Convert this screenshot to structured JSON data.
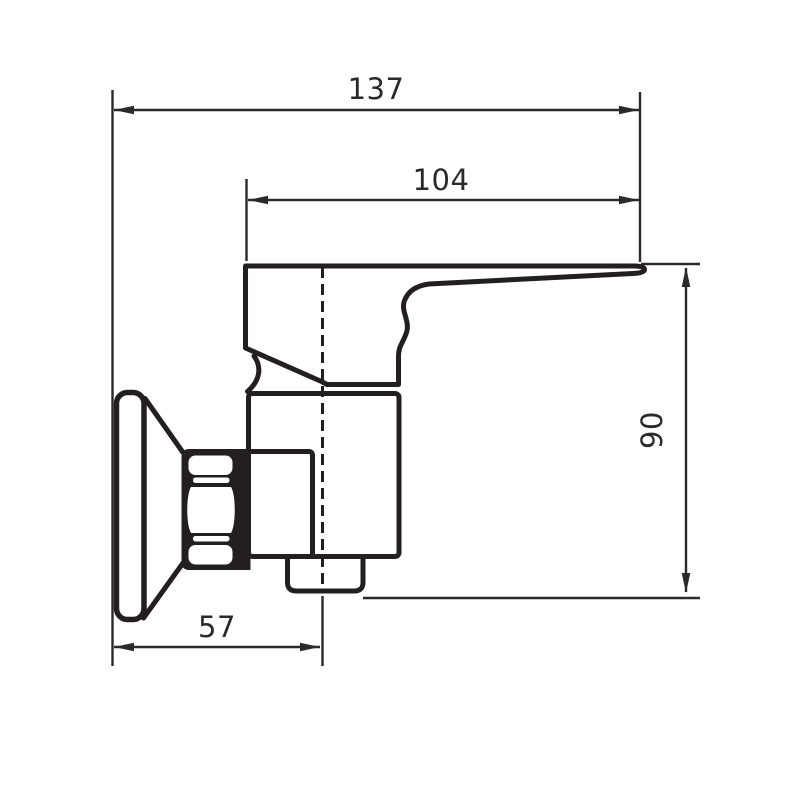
{
  "page": {
    "background": "#ffffff"
  },
  "drawing": {
    "title": "Wall-mounted single-lever mixer tap - side view dimension drawing",
    "line_color": "#231f20",
    "dimension_color": "#2a2a2a",
    "dimensions": {
      "overall_depth_from_wall": "137",
      "lever_projection": "104",
      "overall_height": "90",
      "wall_to_body_centerline": "57"
    }
  }
}
